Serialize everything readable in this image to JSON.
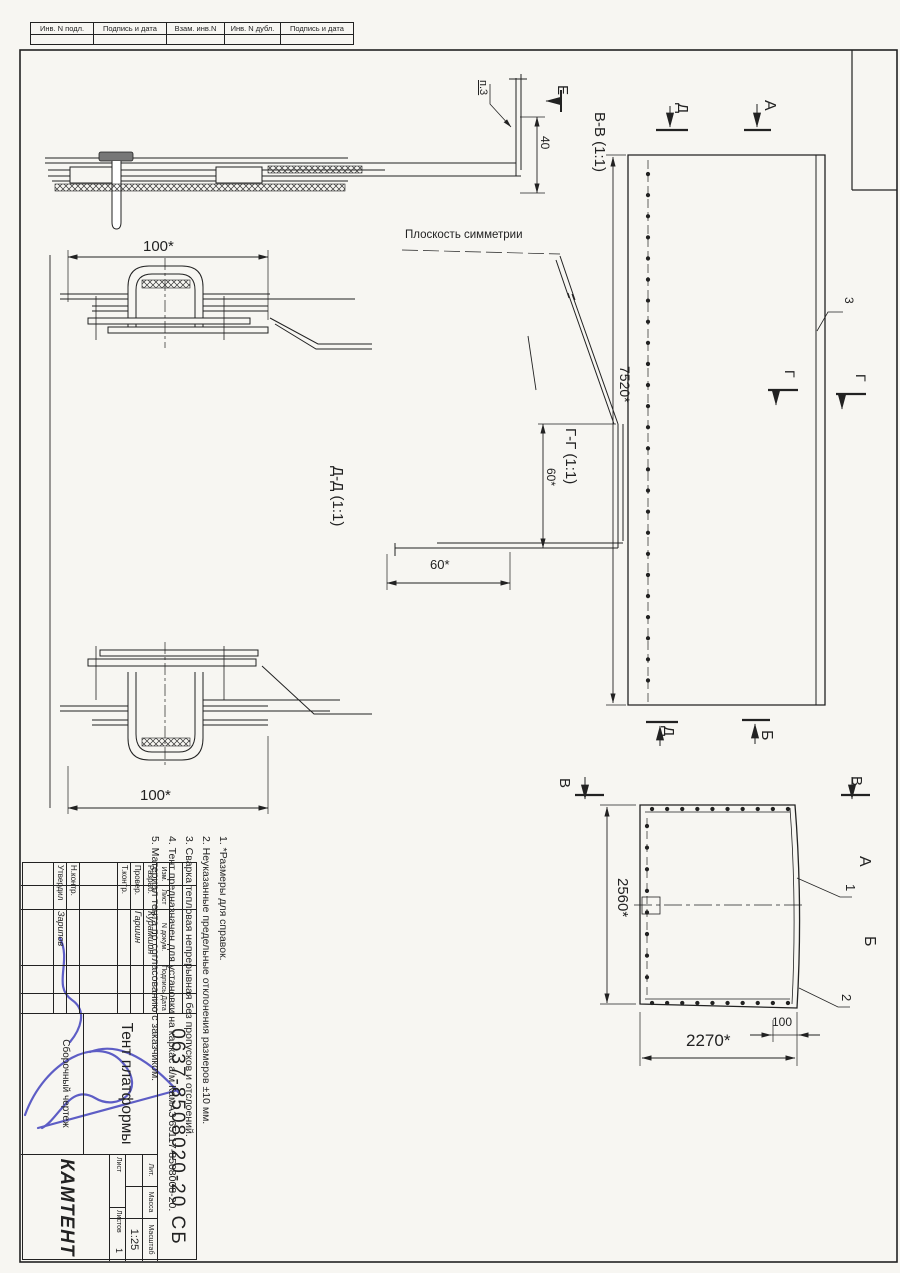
{
  "colors": {
    "ink": "#222222",
    "paper": "#f7f6f2",
    "blue": "#4343be"
  },
  "margin_strip": {
    "cells": [
      "Инв. N подл.",
      "Подпись и дата",
      "Взам. инв.N",
      "Инв. N дубл.",
      "Подпись и дата"
    ]
  },
  "views": {
    "section_vv": "В-В  (1:1)",
    "section_gg": "Г-Г  (1:1)",
    "section_dd": "Д-Д  (1:1)",
    "symmetry_plane": "Плоскость симметрии",
    "point_ref": "п.3"
  },
  "view_letters": {
    "e": "Е",
    "a_top": "А",
    "d_top": "Д",
    "d_bottom": "Д",
    "b_bottom": "Б",
    "g1": "Г",
    "g2": "Г",
    "v_left": "В",
    "v_right": "В",
    "a_side": "А",
    "b_side": "Б"
  },
  "positions": {
    "p1": "1",
    "p2": "2",
    "p3": "3"
  },
  "dims": {
    "d40": "40",
    "top_100": "100*",
    "bottom_100": "100*",
    "v60": "60*",
    "h60": "60*",
    "plan_length": "7520*",
    "side_height": "2560*",
    "side_width": "2270*",
    "side_100": "100"
  },
  "notes": {
    "items": [
      "1. *Размеры для справок.",
      "2. Неуказанные предельные отклонения размеров ±10 мм.",
      "3. Сварка тепловая непрерывная без пропусков и отслоений.",
      "4. Тент предназначен для установки на каркас а/м КамАЗ 65117-8508008-20.",
      "5. Материал тента по согласованию с заказчиком."
    ]
  },
  "title_block": {
    "doc_number": "0637-8508020-20 СБ",
    "name": "Тент платформы",
    "doc_type": "Сборочный чертеж",
    "company": "КАМТЕНТ",
    "scale": "1:25",
    "scale_label": "Масштаб",
    "lit_label": "Лит.",
    "mass_label": "Масса",
    "sheet_label": "Лист",
    "sheets_label": "Листов",
    "sheets_count": "1",
    "header_cells": [
      "Изм.",
      "Лист",
      "N докум.",
      "Подпись",
      "Дата"
    ],
    "rows": [
      {
        "role": "Разраб.",
        "name": "Курамшин"
      },
      {
        "role": "Провер.",
        "name": "Гаршин"
      },
      {
        "role": "Т.контр.",
        "name": ""
      },
      {
        "role": "Н.контр.",
        "name": ""
      },
      {
        "role": "Утвердил",
        "name": "Зарипов"
      }
    ]
  }
}
